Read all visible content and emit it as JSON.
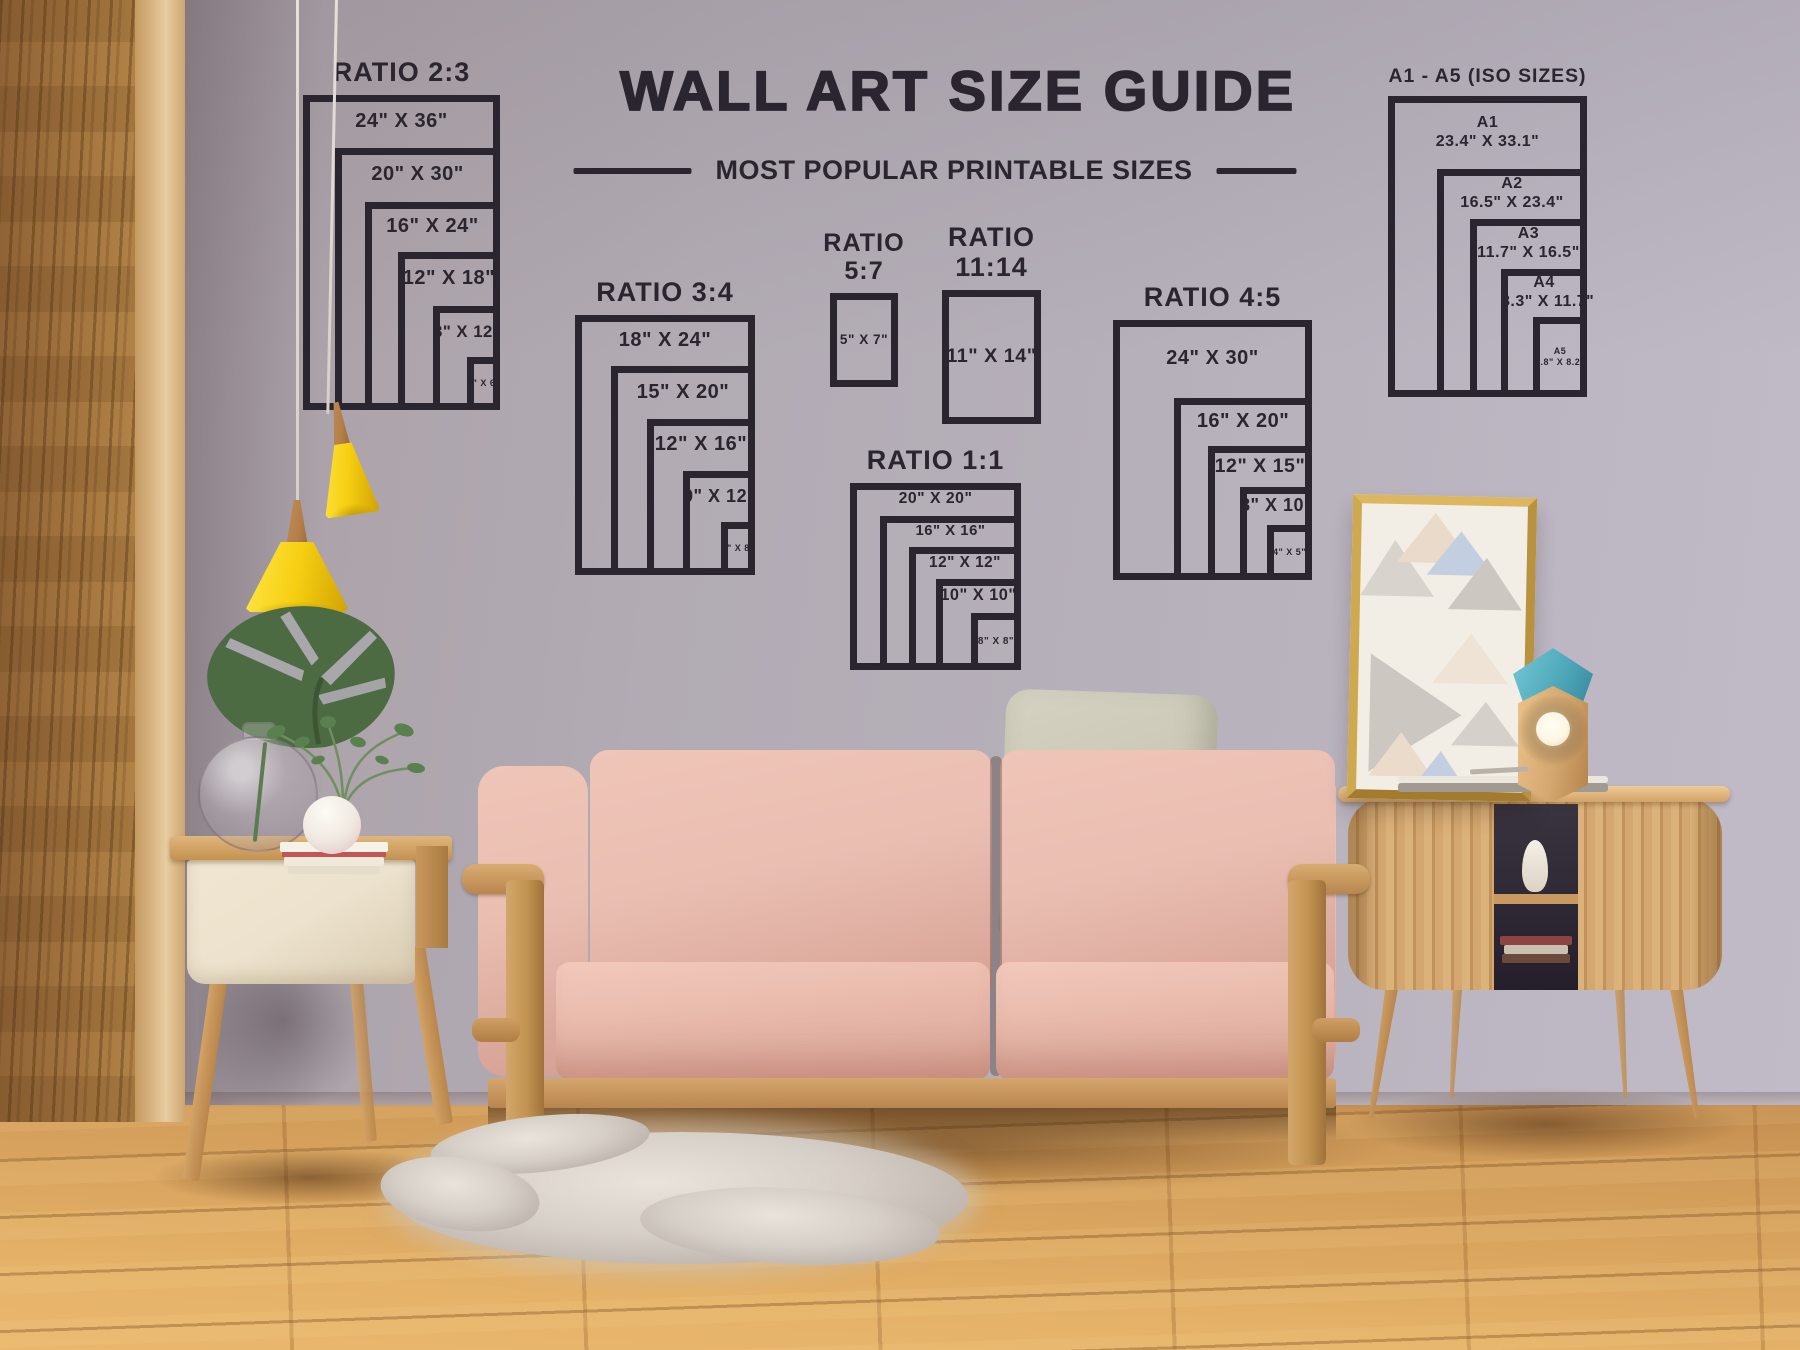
{
  "header": {
    "title": "WALL ART SIZE GUIDE",
    "subtitle": "MOST POPULAR PRINTABLE SIZES"
  },
  "palette": {
    "ink": "#2b2530",
    "wall-light": "#c1bbc7",
    "wall-mid": "#b2abb4",
    "wall-dark": "#a0959b",
    "floor-light": "#eab76e",
    "floor-mid": "#d9a45e",
    "floor-dark": "#c38c4f",
    "panel-wood": "#a5763f",
    "panel-bevel": "#dcb988",
    "lamp-yellow": "#f6cf12",
    "lamp-wood": "#b5804b",
    "cord": "#e6e1d8",
    "sofa-pink": "#eabfb2",
    "sofa-pink-deep": "#d5a093",
    "frame-wood": "#c99c66",
    "pillow-sage": "#c9c6b4",
    "cabinet-wood": "#d3a76f",
    "cream": "#ece2cd",
    "leaf-green": "#4c6b42",
    "plant-green": "#5a8050",
    "book-red": "#c25557",
    "rug-gray": "#d6cfc7",
    "poster-bg": "#f3eee5",
    "tri-gray": "#cdc7c2",
    "tri-beige": "#e9dac9",
    "tri-blue": "#c3cfe1",
    "gold": "#c9a24c",
    "teal": "#4da5b8",
    "bulb": "#fdf6e3"
  },
  "charts": [
    {
      "id": "ratio-2-3",
      "title_lines": [
        "RATIO 2:3"
      ],
      "box": {
        "x": 303,
        "y": 95,
        "w": 197,
        "h": 315
      },
      "items": [
        {
          "lines": [
            "24\" X 36\""
          ],
          "w_in": 24,
          "h_in": 36,
          "rect": [
            0,
            0
          ]
        },
        {
          "lines": [
            "20\" X 30\""
          ],
          "w_in": 20,
          "h_in": 30,
          "rect": [
            0.163,
            0.168
          ]
        },
        {
          "lines": [
            "16\" X 24\""
          ],
          "w_in": 16,
          "h_in": 24,
          "rect": [
            0.315,
            0.34
          ]
        },
        {
          "lines": [
            "12\" X 18\""
          ],
          "w_in": 12,
          "h_in": 18,
          "rect": [
            0.482,
            0.498
          ]
        },
        {
          "lines": [
            "8\" X 12\""
          ],
          "w_in": 8,
          "h_in": 12,
          "rect": [
            0.66,
            0.67
          ]
        },
        {
          "lines": [
            "4\" X 6\""
          ],
          "w_in": 4,
          "h_in": 6,
          "rect": [
            0.833,
            0.832
          ]
        }
      ]
    },
    {
      "id": "ratio-3-4",
      "title_lines": [
        "RATIO 3:4"
      ],
      "box": {
        "x": 575,
        "y": 315,
        "w": 180,
        "h": 260
      },
      "items": [
        {
          "lines": [
            "18\" X 24\""
          ],
          "w_in": 18,
          "h_in": 24,
          "rect": [
            0,
            0
          ]
        },
        {
          "lines": [
            "15\" X 20\""
          ],
          "w_in": 15,
          "h_in": 20,
          "rect": [
            0.2,
            0.196
          ]
        },
        {
          "lines": [
            "12\" X 16\""
          ],
          "w_in": 12,
          "h_in": 16,
          "rect": [
            0.4,
            0.4
          ]
        },
        {
          "lines": [
            "9\" X 12\""
          ],
          "w_in": 9,
          "h_in": 12,
          "rect": [
            0.6,
            0.6
          ]
        },
        {
          "lines": [
            "6\" X 8\""
          ],
          "w_in": 6,
          "h_in": 8,
          "rect": [
            0.811,
            0.796
          ]
        }
      ]
    },
    {
      "id": "ratio-5-7",
      "title_lines": [
        "RATIO",
        "5:7"
      ],
      "box": {
        "x": 830,
        "y": 293,
        "w": 68,
        "h": 94
      },
      "items": [
        {
          "lines": [
            "5\" X 7\""
          ],
          "w_in": 5,
          "h_in": 7,
          "rect": [
            0,
            0
          ]
        }
      ]
    },
    {
      "id": "ratio-11-14",
      "title_lines": [
        "RATIO",
        "11:14"
      ],
      "box": {
        "x": 942,
        "y": 290,
        "w": 99,
        "h": 134
      },
      "items": [
        {
          "lines": [
            "11\" X 14\""
          ],
          "w_in": 11,
          "h_in": 14,
          "rect": [
            0,
            0
          ]
        }
      ]
    },
    {
      "id": "ratio-1-1",
      "title_lines": [
        "RATIO 1:1"
      ],
      "box": {
        "x": 850,
        "y": 483,
        "w": 171,
        "h": 187
      },
      "items": [
        {
          "lines": [
            "20\" X 20\""
          ],
          "w_in": 20,
          "h_in": 20,
          "rect": [
            0,
            0
          ]
        },
        {
          "lines": [
            "16\" X 16\""
          ],
          "w_in": 16,
          "h_in": 16,
          "rect": [
            0.175,
            0.176
          ]
        },
        {
          "lines": [
            "12\" X 12\""
          ],
          "w_in": 12,
          "h_in": 12,
          "rect": [
            0.345,
            0.342
          ]
        },
        {
          "lines": [
            "10\" X 10\""
          ],
          "w_in": 10,
          "h_in": 10,
          "rect": [
            0.503,
            0.513
          ]
        },
        {
          "lines": [
            "8\" X 8\""
          ],
          "w_in": 8,
          "h_in": 8,
          "rect": [
            0.708,
            0.695
          ]
        }
      ]
    },
    {
      "id": "ratio-4-5",
      "title_lines": [
        "RATIO 4:5"
      ],
      "box": {
        "x": 1113,
        "y": 320,
        "w": 199,
        "h": 260
      },
      "items": [
        {
          "lines": [
            "24\" X 30\""
          ],
          "w_in": 24,
          "h_in": 30,
          "rect": [
            0,
            0
          ]
        },
        {
          "lines": [
            "16\" X 20\""
          ],
          "w_in": 16,
          "h_in": 20,
          "rect": [
            0.307,
            0.3
          ]
        },
        {
          "lines": [
            "12\" X 15\""
          ],
          "w_in": 12,
          "h_in": 15,
          "rect": [
            0.477,
            0.485
          ]
        },
        {
          "lines": [
            "8\" X 10\""
          ],
          "w_in": 8,
          "h_in": 10,
          "rect": [
            0.638,
            0.642
          ]
        },
        {
          "lines": [
            "4\" X 5\""
          ],
          "w_in": 4,
          "h_in": 5,
          "rect": [
            0.774,
            0.788
          ]
        }
      ]
    },
    {
      "id": "iso-a1-a5",
      "title_lines": [
        "A1 - A5 (ISO SIZES)"
      ],
      "box": {
        "x": 1388,
        "y": 96,
        "w": 199,
        "h": 301
      },
      "items": [
        {
          "lines": [
            "A1",
            "23.4\" X 33.1\""
          ],
          "w_in": 23.4,
          "h_in": 33.1,
          "rect": [
            0,
            0
          ]
        },
        {
          "lines": [
            "A2",
            "16.5\" X 23.4\""
          ],
          "w_in": 16.5,
          "h_in": 23.4,
          "rect": [
            0.246,
            0.243
          ]
        },
        {
          "lines": [
            "A3",
            "11.7\" X 16.5\""
          ],
          "w_in": 11.7,
          "h_in": 16.5,
          "rect": [
            0.412,
            0.409
          ]
        },
        {
          "lines": [
            "A4",
            "8.3\" X 11.7\""
          ],
          "w_in": 8.3,
          "h_in": 11.7,
          "rect": [
            0.568,
            0.575
          ]
        },
        {
          "lines": [
            "A5",
            "5.8\" X 8.2\""
          ],
          "w_in": 5.8,
          "h_in": 8.2,
          "rect": [
            0.729,
            0.734
          ]
        }
      ]
    }
  ]
}
